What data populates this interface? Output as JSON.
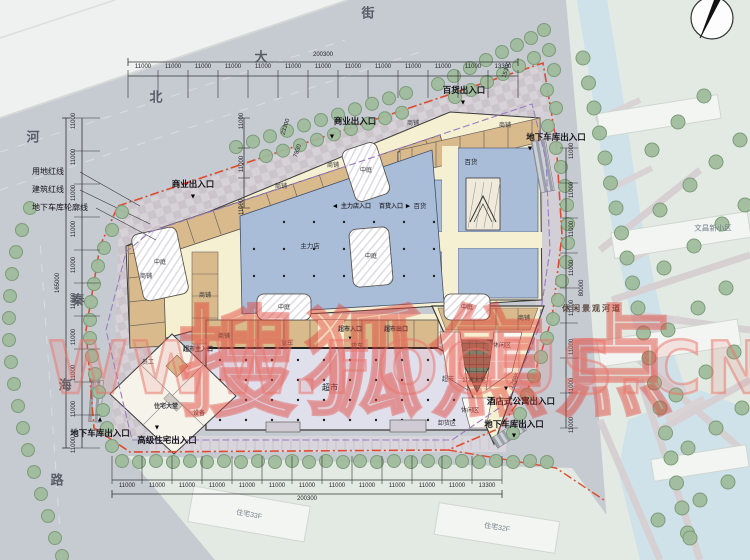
{
  "watermark": {
    "brand": "搜狐焦点",
    "site": "WWW.FOCUS.CN"
  },
  "icons": {
    "down": "▼",
    "up": "▲",
    "left": "◀",
    "right": "▶"
  },
  "roads": {
    "north_street": [
      "街",
      "大",
      "北"
    ],
    "west_road": [
      "河",
      "秦",
      "海",
      "路"
    ]
  },
  "legend": {
    "land_red_line": "用地红线",
    "building_red_line": "建筑红线",
    "garage_outline": "地下车库轮廓线"
  },
  "entrances": {
    "commercial": "商业出入口",
    "department_store": "百货出入口",
    "garage": "地下车库出入口",
    "premium_residence": "高级住宅出入口",
    "hotel_apartment": "酒店式公寓出入口",
    "anchor": "主力店入口",
    "department": "百货入口",
    "supermarket_main": "超市主入口",
    "supermarket_in": "超市入口",
    "supermarket_out": "超市出口"
  },
  "areas": {
    "anchor": "主力店",
    "department": "百货",
    "supermarket": "超市",
    "atrium": "中庭",
    "shop": "商铺",
    "truck": "货车",
    "unloading": "卸货区",
    "staff": "员工",
    "equipment": "设备",
    "residence_lobby": "住宅大堂",
    "apartment_lobby": "公寓大堂",
    "leisure": "休闲区"
  },
  "surroundings": {
    "district": "文昌新小区",
    "river": "休闲景观河道",
    "tower_left": "住宅33F",
    "tower_right": "住宅32F"
  },
  "dimensions": {
    "top_total": "200300",
    "bottom_total": "200300",
    "left_total": "165000",
    "right_total": "80000",
    "road_width_1": "23300",
    "road_width_2": "7930",
    "misc_1": "12885",
    "misc_2": "15300",
    "top_segments": [
      "11000",
      "11000",
      "11000",
      "11000",
      "11000",
      "11000",
      "11000",
      "11000",
      "11000",
      "11000",
      "11000",
      "11000",
      "13300"
    ],
    "bottom_segments": [
      "11000",
      "11000",
      "11000",
      "11000",
      "11000",
      "11000",
      "11000",
      "11000",
      "11000",
      "11000",
      "11000",
      "11000",
      "13300"
    ],
    "left_segments": [
      "11000",
      "11000",
      "11000",
      "11000",
      "11000",
      "11000",
      "11000",
      "11000",
      "11000",
      "11000"
    ],
    "left_edge_segments": [
      "11000",
      "11000",
      "11000"
    ],
    "right_segments": [
      "11000",
      "11000",
      "11000",
      "11000",
      "11000",
      "11000",
      "11000",
      "11000"
    ]
  }
}
